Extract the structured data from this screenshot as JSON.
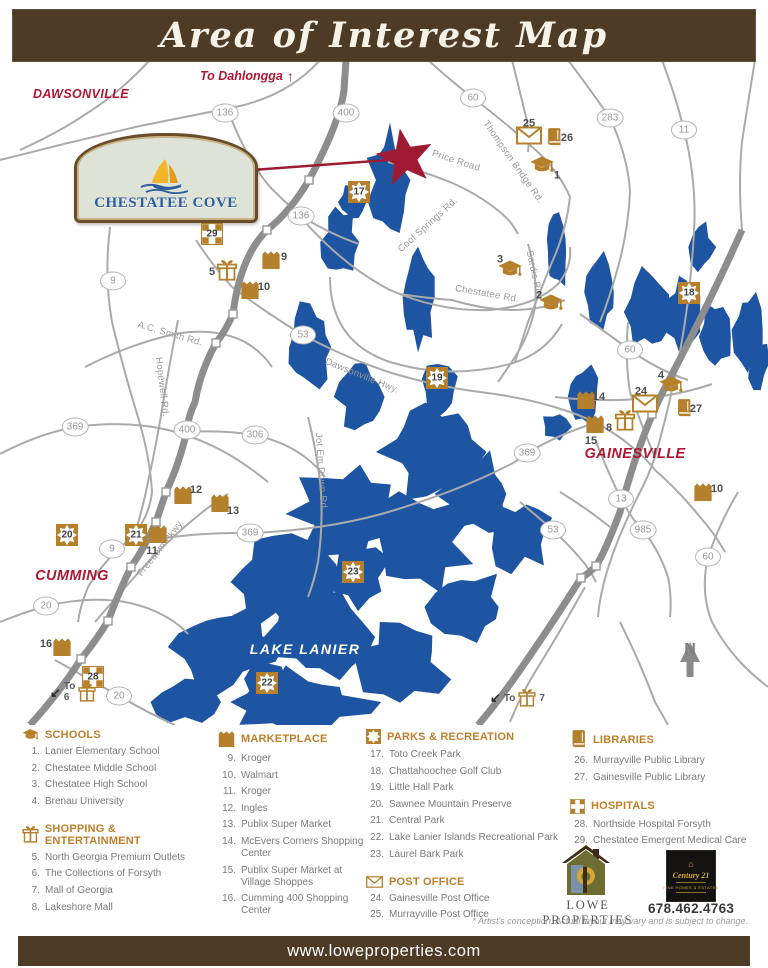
{
  "banner": {
    "title": "Area of Interest Map"
  },
  "map": {
    "sign": {
      "name": "CHESTATEE COVE"
    },
    "dahlonega": {
      "text": "To Dahlongga"
    },
    "compass": "N",
    "lake_label": {
      "text": "LAKE LANIER",
      "x": 305,
      "y": 587
    },
    "cities": [
      {
        "name": "DAWSONVILLE",
        "x": 81,
        "y": 32,
        "fs": 12.5
      },
      {
        "name": "CUMMING",
        "x": 72,
        "y": 514,
        "fs": 14.5
      },
      {
        "name": "GAINESVILLE",
        "x": 635,
        "y": 392,
        "fs": 14.5
      }
    ],
    "road_labels": [
      {
        "text": "Price Road",
        "x": 456,
        "y": 99,
        "a": 18
      },
      {
        "text": "Thompson Bridge Rd.",
        "x": 513,
        "y": 100,
        "a": 55
      },
      {
        "text": "Cool Springs Rd.",
        "x": 428,
        "y": 163,
        "a": -42
      },
      {
        "text": "Sardis Rd.",
        "x": 534,
        "y": 212,
        "a": 78
      },
      {
        "text": "Chestatee Rd.",
        "x": 487,
        "y": 232,
        "a": 10
      },
      {
        "text": "A.C. Smith Rd.",
        "x": 170,
        "y": 272,
        "a": 16
      },
      {
        "text": "Hopewell Rd.",
        "x": 162,
        "y": 325,
        "a": 83
      },
      {
        "text": "Dawsonville Hwy.",
        "x": 362,
        "y": 314,
        "a": 22
      },
      {
        "text": "Jot Em Down Rd.",
        "x": 321,
        "y": 410,
        "a": 86
      },
      {
        "text": "Freedom Pkwy.",
        "x": 161,
        "y": 486,
        "a": -52
      }
    ],
    "route_shields": [
      {
        "n": "136",
        "x": 225,
        "y": 51
      },
      {
        "n": "400",
        "x": 346,
        "y": 51
      },
      {
        "n": "60",
        "x": 473,
        "y": 36
      },
      {
        "n": "283",
        "x": 610,
        "y": 56
      },
      {
        "n": "11",
        "x": 684,
        "y": 68
      },
      {
        "n": "136",
        "x": 301,
        "y": 154
      },
      {
        "n": "9",
        "x": 113,
        "y": 219
      },
      {
        "n": "53",
        "x": 303,
        "y": 273
      },
      {
        "n": "60",
        "x": 630,
        "y": 288
      },
      {
        "n": "369",
        "x": 75,
        "y": 365
      },
      {
        "n": "400",
        "x": 187,
        "y": 368
      },
      {
        "n": "306",
        "x": 255,
        "y": 373
      },
      {
        "n": "369",
        "x": 527,
        "y": 391
      },
      {
        "n": "13",
        "x": 621,
        "y": 437
      },
      {
        "n": "369",
        "x": 250,
        "y": 471
      },
      {
        "n": "9",
        "x": 112,
        "y": 487
      },
      {
        "n": "985",
        "x": 643,
        "y": 468
      },
      {
        "n": "53",
        "x": 553,
        "y": 468
      },
      {
        "n": "20",
        "x": 46,
        "y": 544
      },
      {
        "n": "60",
        "x": 708,
        "y": 495
      },
      {
        "n": "20",
        "x": 119,
        "y": 634
      }
    ],
    "markers": [
      {
        "n": "1",
        "t": "school",
        "x": 542,
        "y": 106,
        "lx": 15,
        "ly": 7
      },
      {
        "n": "2",
        "t": "school",
        "x": 551,
        "y": 244,
        "lx": -12,
        "ly": -11
      },
      {
        "n": "3",
        "t": "school",
        "x": 510,
        "y": 210,
        "lx": -10,
        "ly": -13
      },
      {
        "n": "4",
        "t": "school",
        "x": 671,
        "y": 326,
        "lx": -10,
        "ly": -13
      },
      {
        "n": "5",
        "t": "shopping",
        "x": 227,
        "y": 211,
        "lx": -15,
        "ly": -1
      },
      {
        "n": "8",
        "t": "shopping",
        "x": 625,
        "y": 361,
        "lx": -16,
        "ly": 5
      },
      {
        "n": "9",
        "t": "market",
        "x": 271,
        "y": 200,
        "lx": 13,
        "ly": -5
      },
      {
        "n": "10",
        "t": "market",
        "x": 250,
        "y": 230,
        "lx": 14,
        "ly": -5
      },
      {
        "n": "11",
        "t": "market",
        "x": 158,
        "y": 474,
        "lx": -6,
        "ly": 15
      },
      {
        "n": "12",
        "t": "market",
        "x": 183,
        "y": 435,
        "lx": 13,
        "ly": -7
      },
      {
        "n": "13",
        "t": "market",
        "x": 220,
        "y": 443,
        "lx": 13,
        "ly": 6
      },
      {
        "n": "14",
        "t": "market",
        "x": 586,
        "y": 340,
        "lx": 13,
        "ly": -5
      },
      {
        "n": "15",
        "t": "market",
        "x": 595,
        "y": 364,
        "lx": -4,
        "ly": 15
      },
      {
        "n": "10",
        "t": "market",
        "x": 703,
        "y": 432,
        "lx": 14,
        "ly": -5
      },
      {
        "n": "16",
        "t": "market",
        "x": 62,
        "y": 587,
        "lx": -16,
        "ly": -5
      },
      {
        "n": "17",
        "t": "park",
        "x": 359,
        "y": 130
      },
      {
        "n": "18",
        "t": "park",
        "x": 689,
        "y": 231
      },
      {
        "n": "19",
        "t": "park",
        "x": 437,
        "y": 316
      },
      {
        "n": "20",
        "t": "park",
        "x": 67,
        "y": 473
      },
      {
        "n": "21",
        "t": "park",
        "x": 136,
        "y": 473
      },
      {
        "n": "22",
        "t": "park",
        "x": 267,
        "y": 621
      },
      {
        "n": "23",
        "t": "park",
        "x": 353,
        "y": 510
      },
      {
        "n": "24",
        "t": "post",
        "x": 645,
        "y": 344,
        "lx": -4,
        "ly": -15
      },
      {
        "n": "25",
        "t": "post",
        "x": 529,
        "y": 76,
        "lx": 0,
        "ly": -15
      },
      {
        "n": "26",
        "t": "library",
        "x": 554,
        "y": 78,
        "lx": 13,
        "ly": -2
      },
      {
        "n": "27",
        "t": "library",
        "x": 684,
        "y": 349,
        "lx": 12,
        "ly": -2
      },
      {
        "n": "28",
        "t": "hospital",
        "x": 93,
        "y": 615
      },
      {
        "n": "29",
        "t": "hospital",
        "x": 212,
        "y": 172
      }
    ],
    "to_notes": [
      {
        "label": "To",
        "num": "6",
        "x": 50,
        "y": 620,
        "stack": true
      },
      {
        "label": "To",
        "num": "7",
        "x": 490,
        "y": 626,
        "stack": false
      }
    ]
  },
  "legend": {
    "sections": [
      {
        "col": 1,
        "icon": "school",
        "title": "SCHOOLS",
        "items": [
          {
            "n": "1.",
            "text": "Lanier Elementary School"
          },
          {
            "n": "2.",
            "text": "Chestatee Middle School"
          },
          {
            "n": "3.",
            "text": "Chestatee High School"
          },
          {
            "n": "4.",
            "text": "Brenau University"
          }
        ]
      },
      {
        "col": 1,
        "icon": "shopping",
        "title": "SHOPPING & ENTERTAINMENT",
        "items": [
          {
            "n": "5.",
            "text": "North Georgia Premium Outlets"
          },
          {
            "n": "6.",
            "text": "The Collections of Forsyth"
          },
          {
            "n": "7.",
            "text": "Mall of Georgia"
          },
          {
            "n": "8.",
            "text": "Lakeshore Mall"
          }
        ]
      },
      {
        "col": 2,
        "icon": "market",
        "title": "MARKETPLACE",
        "items": [
          {
            "n": "9.",
            "text": "Kroger"
          },
          {
            "n": "10.",
            "text": "Walmart"
          },
          {
            "n": "11.",
            "text": "Kroger"
          },
          {
            "n": "12.",
            "text": "Ingles"
          },
          {
            "n": "13.",
            "text": "Publix Super Market"
          },
          {
            "n": "14.",
            "text": "McEvers Corners Shopping Center"
          },
          {
            "n": "15.",
            "text": "Publix Super Market at Village Shoppes"
          },
          {
            "n": "16.",
            "text": "Cumming 400 Shopping Center"
          }
        ]
      },
      {
        "col": 3,
        "icon": "park",
        "title": "PARKS & RECREATION",
        "items": [
          {
            "n": "17.",
            "text": "Toto Creek Park"
          },
          {
            "n": "18.",
            "text": "Chattahoochee Golf Club"
          },
          {
            "n": "19.",
            "text": "Little Hall Park"
          },
          {
            "n": "20.",
            "text": "Sawnee Mountain Preserve"
          },
          {
            "n": "21.",
            "text": "Central Park"
          },
          {
            "n": "22.",
            "text": "Lake Lanier Islands Recreational Park"
          },
          {
            "n": "23.",
            "text": "Laurel Bark Park"
          }
        ]
      },
      {
        "col": 3,
        "icon": "post",
        "title": "POST OFFICE",
        "items": [
          {
            "n": "24.",
            "text": "Gainesville Post Office"
          },
          {
            "n": "25.",
            "text": "Murrayville Post Office"
          }
        ]
      },
      {
        "col": 4,
        "icon": "library",
        "title": "LIBRARIES",
        "items": [
          {
            "n": "26.",
            "text": "Murrayville Public Library"
          },
          {
            "n": "27.",
            "text": "Gainesville Public Library"
          }
        ]
      },
      {
        "col": 4,
        "icon": "hospital",
        "title": "HOSPITALS",
        "items": [
          {
            "n": "28.",
            "text": "Northside Hospital Forsyth"
          },
          {
            "n": "29.",
            "text": "Chestatee Emergent Medical Care"
          }
        ]
      }
    ]
  },
  "footer": {
    "brand": "LOWE PROPERTIES",
    "phone": "678.462.4763",
    "c21_line1": "Century 21",
    "c21_line2": "FINE HOMES & ESTATES",
    "disclaimer": "* Artist's conception.  Actual layout may vary and is subject to change.",
    "website": "www.loweproperties.com"
  }
}
